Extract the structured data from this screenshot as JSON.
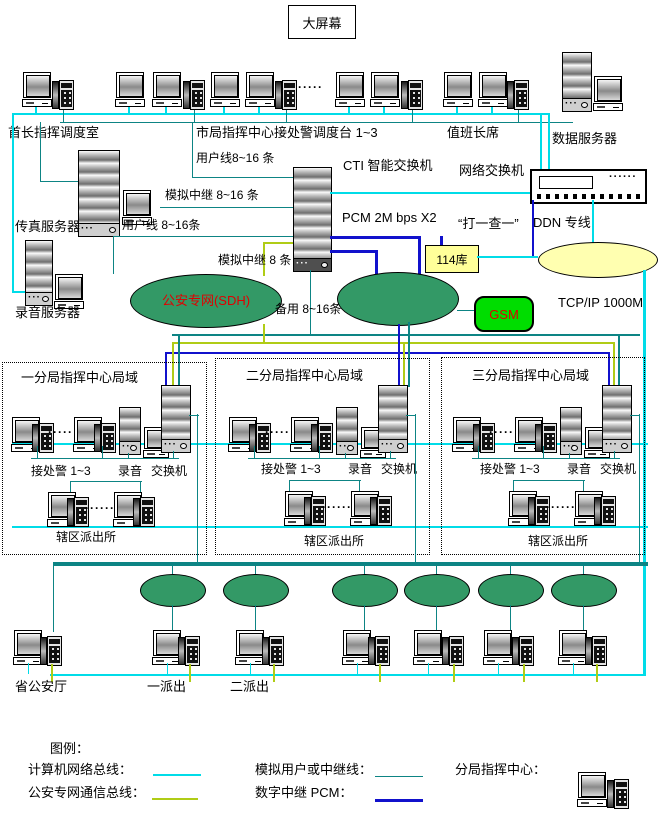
{
  "misc": {
    "dots5": "·····",
    "dots6": "······"
  },
  "colors": {
    "computer_bus_cyan": "#00dce8",
    "analog_teal": "#0d8484",
    "police_net_green": "#b0cc16",
    "pcm_blue": "#1111cc",
    "cloud_green": "#339966",
    "gsm_green": "#00dd00",
    "db_yellow": "#ffff99",
    "ddn_yellow": "#ffffb0",
    "accent_red": "#e00000"
  },
  "top": {
    "screen": "大屏幕",
    "chief_room": "首长指挥调度室",
    "city_dispatch": "市局指挥中心接处警调度台 1~3",
    "duty_chief": "值班长席",
    "data_server": "数据服务器"
  },
  "servers": {
    "fax": "传真服务器",
    "record": "录音服务器"
  },
  "center": {
    "cti": "CTI 智能交换机",
    "net_switch": "网络交换机",
    "pcm": "PCM 2M bps X2",
    "da_yi_cha_yi": "“打一查一”",
    "ddn_line": "DDN 专线",
    "db114": "114库",
    "gsm": "GSM",
    "sdh_net": "公安专网(SDH)",
    "tcpip": "TCP/IP   1000M",
    "user_line_1": "用户线8~16 条",
    "analog_trunk_1": "模拟中继 8~16 条",
    "user_line_2": "用户线 8~16条",
    "analog_trunk_2": "模拟中继 8 条",
    "backup": "备用 8~16条"
  },
  "branches": [
    {
      "title": "一分局指挥中心局域",
      "dispatch": "接处警 1~3",
      "record": "录音",
      "pbx": "交换机",
      "station": "辖区派出所"
    },
    {
      "title": "二分局指挥中心局域",
      "dispatch": "接处警 1~3",
      "record": "录音",
      "pbx": "交换机",
      "station": "辖区派出所"
    },
    {
      "title": "三分局指挥中心局域",
      "dispatch": "接处警 1~3",
      "record": "录音",
      "pbx": "交换机",
      "station": "辖区派出所"
    }
  ],
  "bottom": {
    "provincial": "省公安厅",
    "station1": "一派出",
    "station2": "二派出"
  },
  "legend": {
    "title": "图例：",
    "computer_bus": "计算机网络总线：",
    "police_bus": "公安专网通信总线：",
    "analog_line": "模拟用户或中继线：",
    "digital_pcm": "数字中继 PCM：",
    "branch_center": "分局指挥中心："
  }
}
